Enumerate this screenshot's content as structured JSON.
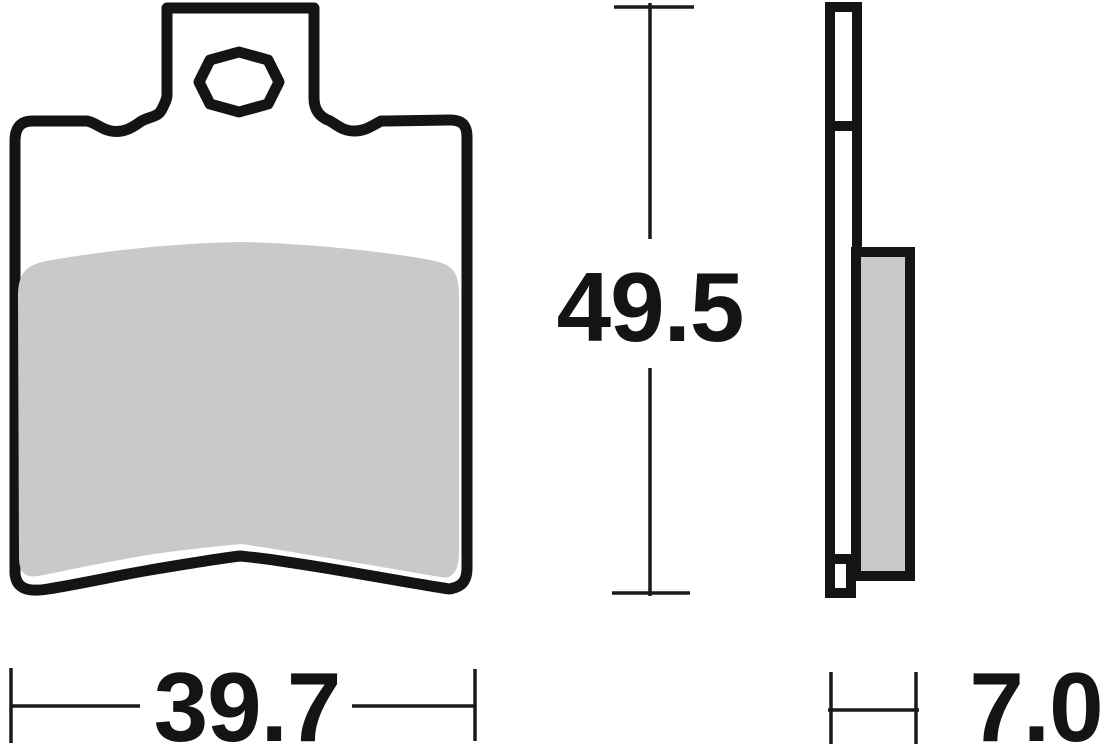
{
  "drawing": {
    "type": "technical-diagram",
    "subject": "brake-pad-two-view-drawing",
    "dimensions": {
      "height": "49.5",
      "width": "39.7",
      "thickness": "7.0"
    },
    "colors": {
      "line": "#141414",
      "friction_fill": "#c9c9c9",
      "background": "#ffffff"
    }
  }
}
